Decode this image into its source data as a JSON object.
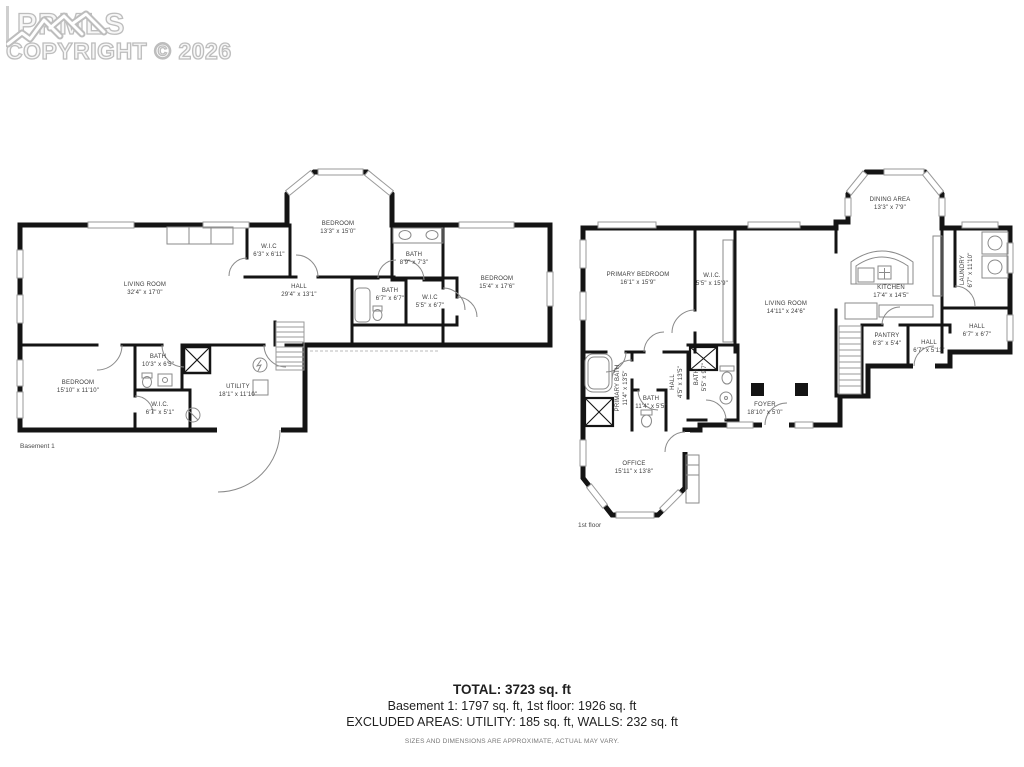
{
  "watermark": {
    "brand": "PPMLS",
    "copyright": "COPYRIGHT © 2026"
  },
  "plans": {
    "basement": {
      "name": "Basement 1",
      "rooms": {
        "living": {
          "label": "LIVING ROOM",
          "dims": "32'4\" x 17'0\""
        },
        "wic_upper": {
          "label": "W.I.C",
          "dims": "6'3\" x 6'11\""
        },
        "bedroom_bay": {
          "label": "BEDROOM",
          "dims": "13'3\" x 15'0\""
        },
        "bath_upper": {
          "label": "BATH",
          "dims": "8'9\" x 7'3\""
        },
        "bedroom_right": {
          "label": "BEDROOM",
          "dims": "15'4\" x 17'6\""
        },
        "hall": {
          "label": "HALL",
          "dims": "29'4\" x 13'1\""
        },
        "bath_mid": {
          "label": "BATH",
          "dims": "6'7\" x 6'7\""
        },
        "wic_mid": {
          "label": "W.I.C",
          "dims": "5'5\" x 6'7\""
        },
        "bedroom_lower": {
          "label": "BEDROOM",
          "dims": "15'10\" x 11'10\""
        },
        "bath_lower": {
          "label": "BATH",
          "dims": "10'3\" x 6'5\""
        },
        "wic_lower": {
          "label": "W.I.C.",
          "dims": "6'7\" x 5'1\""
        },
        "utility": {
          "label": "UTILITY",
          "dims": "18'1\" x 11'10\""
        }
      }
    },
    "first": {
      "name": "1st floor",
      "rooms": {
        "primary_bedroom": {
          "label": "PRIMARY BEDROOM",
          "dims": "16'1\" x 15'9\""
        },
        "wic": {
          "label": "W.I.C.",
          "dims": "5'5\" x 15'9\""
        },
        "living": {
          "label": "LIVING ROOM",
          "dims": "14'11\" x 24'6\""
        },
        "dining": {
          "label": "DINING AREA",
          "dims": "13'3\" x 7'9\""
        },
        "kitchen": {
          "label": "KITCHEN",
          "dims": "17'4\" x 14'5\""
        },
        "laundry": {
          "label": "LAUNDRY",
          "dims": "6'7\" x 11'10\""
        },
        "hall_right": {
          "label": "HALL",
          "dims": "6'7\" x 6'7\""
        },
        "pantry": {
          "label": "PANTRY",
          "dims": "6'3\" x 5'4\""
        },
        "hall_mid": {
          "label": "HALL",
          "dims": "6'7\" x 5'11\""
        },
        "primary_bath": {
          "label": "PRIMARY BATH",
          "dims": "11'4\" x 13'5\""
        },
        "bath_small": {
          "label": "BATH",
          "dims": "11'4\" x 5'5\""
        },
        "hall_lower": {
          "label": "HALL",
          "dims": "4'5\" x 13'5\""
        },
        "bath_foyer": {
          "label": "BATH",
          "dims": "5'5\" x 9'7\""
        },
        "foyer": {
          "label": "FOYER",
          "dims": "18'10\" x 5'0\""
        },
        "office": {
          "label": "OFFICE",
          "dims": "15'11\" x 13'8\""
        }
      }
    }
  },
  "summary": {
    "total": "TOTAL: 3723 sq. ft",
    "floors": "Basement 1: 1797 sq. ft, 1st floor: 1926 sq. ft",
    "excluded": "EXCLUDED AREAS: UTILITY: 185 sq. ft, WALLS: 232 sq. ft",
    "disclaimer": "SIZES AND DIMENSIONS ARE APPROXIMATE, ACTUAL MAY VARY."
  }
}
